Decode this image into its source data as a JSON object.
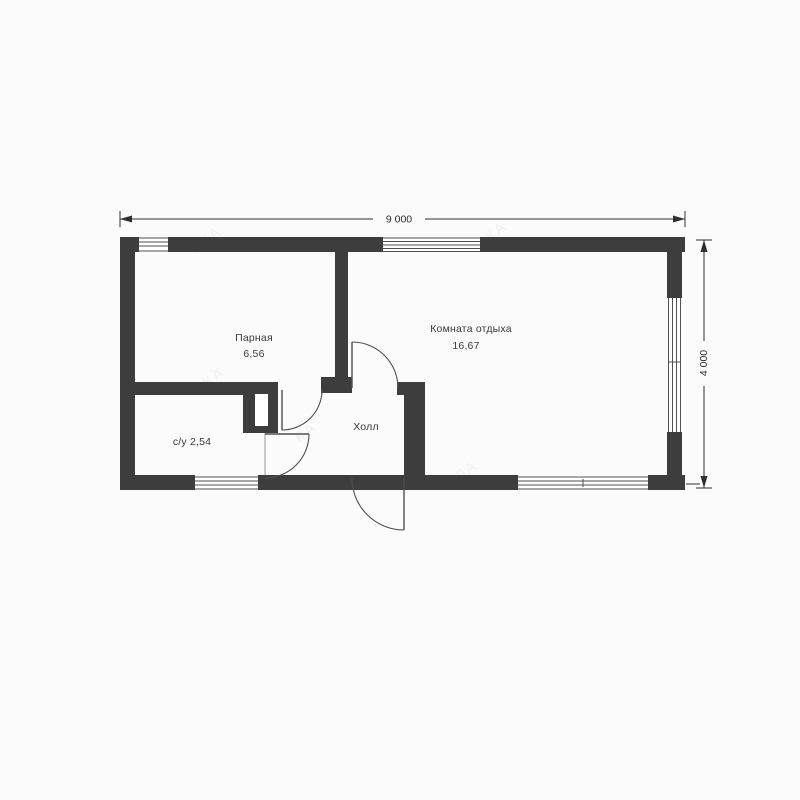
{
  "plan": {
    "type": "floor-plan",
    "rooms": {
      "parnaya": {
        "label": "Парная",
        "area": "6,56"
      },
      "rest": {
        "label": "Комната отдыха",
        "area": "16,67"
      },
      "bathroom": {
        "label": "с/у 2,54"
      },
      "hall": {
        "label": "Холл"
      }
    },
    "dimensions": {
      "width": "9 000",
      "height": "4 000"
    },
    "watermark": {
      "fragments": [
        "СКА",
        "СКА",
        "КА",
        "ЛА",
        "КА"
      ]
    }
  },
  "colors": {
    "background": "#fbfbfb",
    "wall": "#3d3d3d",
    "line": "#4f4f4f",
    "dim": "#2f2f2f",
    "text": "#3a3a3a",
    "window": "#ffffff"
  }
}
